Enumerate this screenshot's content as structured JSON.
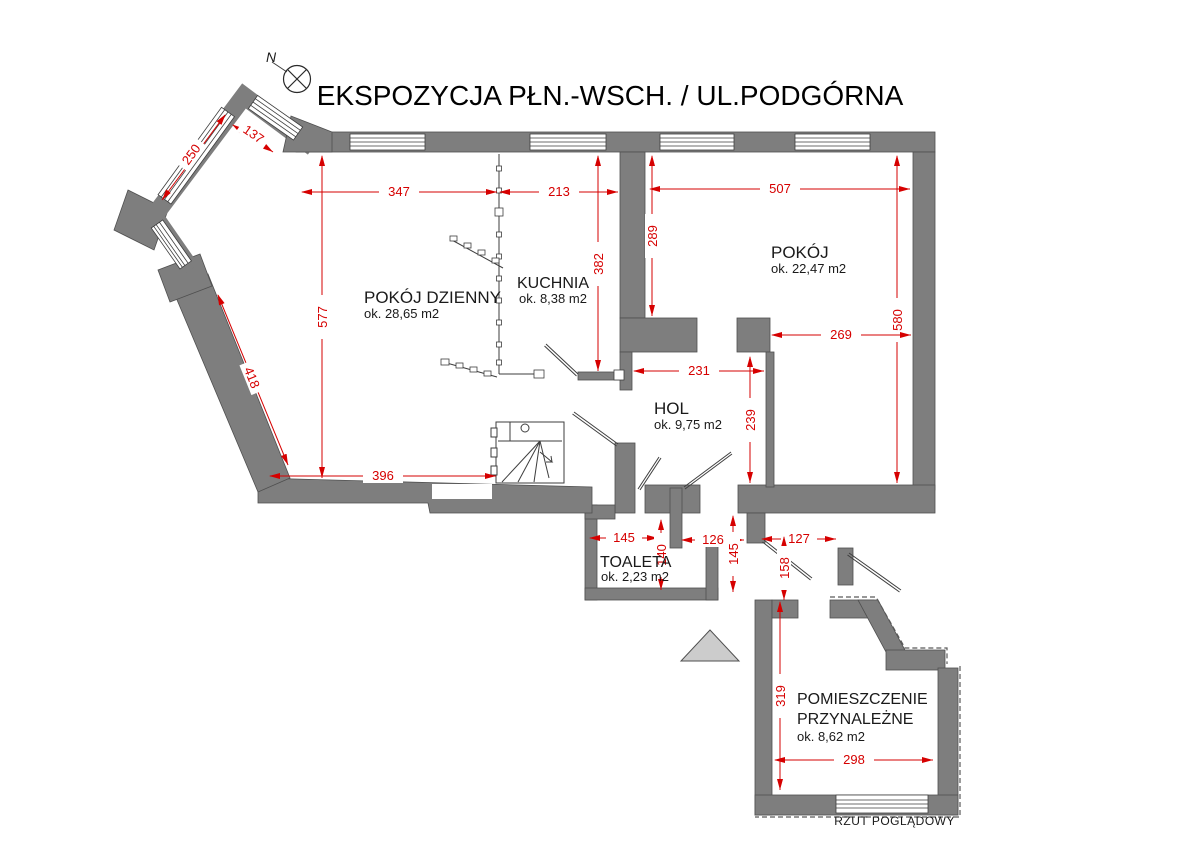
{
  "title": "EKSPOZYCJA PŁN.-WSCH. / UL.PODGÓRNA",
  "footer": "RZUT POGLĄDOWY",
  "compass": {
    "north_label": "N"
  },
  "colors": {
    "wall": "#7e7e7e",
    "wall_outline": "#4f4f4f",
    "dimension": "#d60000",
    "background": "#ffffff",
    "stair_triangle": "#cccccc"
  },
  "rooms": [
    {
      "name": "POKÓJ DZIENNY",
      "area": "ok. 28,65 m2"
    },
    {
      "name": "KUCHNIA",
      "area": "ok. 8,38 m2"
    },
    {
      "name": "POKÓJ",
      "area": "ok. 22,47 m2"
    },
    {
      "name": "HOL",
      "area": "ok. 9,75 m2"
    },
    {
      "name": "TOALETA",
      "area": "ok. 2,23 m2"
    },
    {
      "name": "POMIESZCZENIE PRZYNALEŻNE",
      "name_line1": "POMIESZCZENIE",
      "name_line2": "PRZYNALEŻNE",
      "area": "ok. 8,62 m2"
    }
  ],
  "dims": [
    {
      "id": "bay-window-top",
      "value": "137"
    },
    {
      "id": "bay-window-left",
      "value": "250"
    },
    {
      "id": "living-top-left",
      "value": "347"
    },
    {
      "id": "living-top-right",
      "value": "213"
    },
    {
      "id": "pokoj-top",
      "value": "507"
    },
    {
      "id": "pokoj-left-upper",
      "value": "289"
    },
    {
      "id": "kitchen-height",
      "value": "382"
    },
    {
      "id": "living-left-height",
      "value": "577"
    },
    {
      "id": "living-slant-wall",
      "value": "418"
    },
    {
      "id": "pokoj-right-height",
      "value": "580"
    },
    {
      "id": "pokoj-lower-width",
      "value": "269"
    },
    {
      "id": "hol-top-width",
      "value": "231"
    },
    {
      "id": "hol-right-height",
      "value": "239"
    },
    {
      "id": "living-bottom",
      "value": "396"
    },
    {
      "id": "toaleta-door-width",
      "value": "145"
    },
    {
      "id": "toaleta-height",
      "value": "140"
    },
    {
      "id": "hol-bottom-left",
      "value": "126"
    },
    {
      "id": "corridor-height",
      "value": "145"
    },
    {
      "id": "hol-bottom-right",
      "value": "127"
    },
    {
      "id": "entry-height",
      "value": "158"
    },
    {
      "id": "annex-height",
      "value": "319"
    },
    {
      "id": "annex-width",
      "value": "298"
    }
  ]
}
